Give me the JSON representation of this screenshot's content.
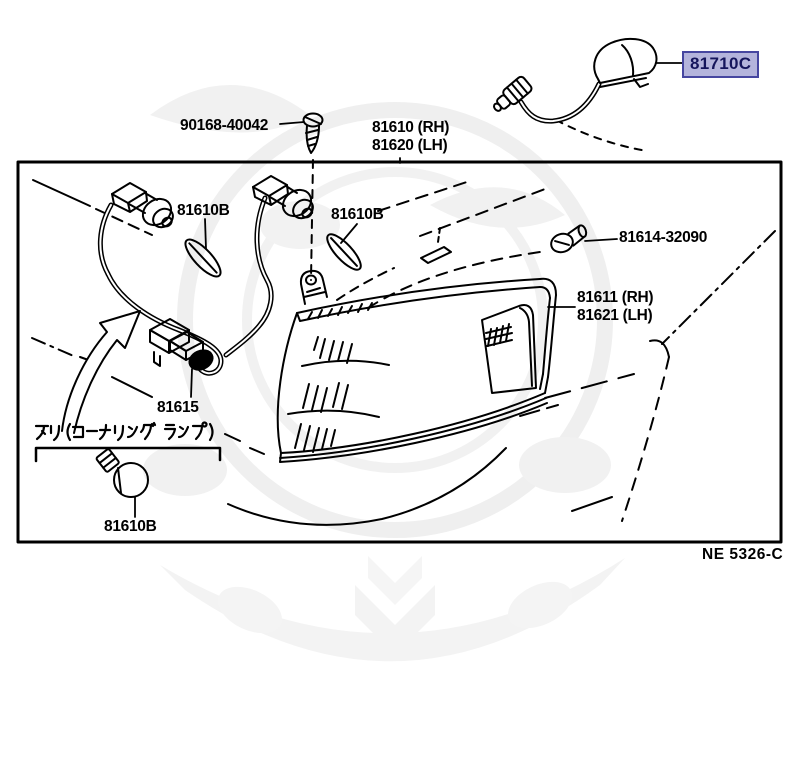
{
  "diagram": {
    "type": "parts-diagram",
    "footer_code": "NE 5326-C",
    "caption_jp": "アリ(コーナリング ランプ)",
    "colors": {
      "line": "#000000",
      "highlight_bg": "#b4b4dc",
      "highlight_border": "#4646a0",
      "highlight_text": "#15155c",
      "watermark": "#f1f1f1"
    },
    "parts": {
      "screw": {
        "number": "90168-40042"
      },
      "lamp_assy": {
        "rh": "81610 (RH)",
        "lh": "81620 (LH)"
      },
      "bulb_a": {
        "number": "81610B"
      },
      "bulb_b": {
        "number": "81610B"
      },
      "bulb_c": {
        "number": "81610B"
      },
      "side_turn_lamp": {
        "number": "81710C",
        "highlighted": true
      },
      "grommet": {
        "number": "81614-32090"
      },
      "lens": {
        "rh": "81611 (RH)",
        "lh": "81621 (LH)"
      },
      "connector": {
        "number": "81615"
      }
    }
  }
}
